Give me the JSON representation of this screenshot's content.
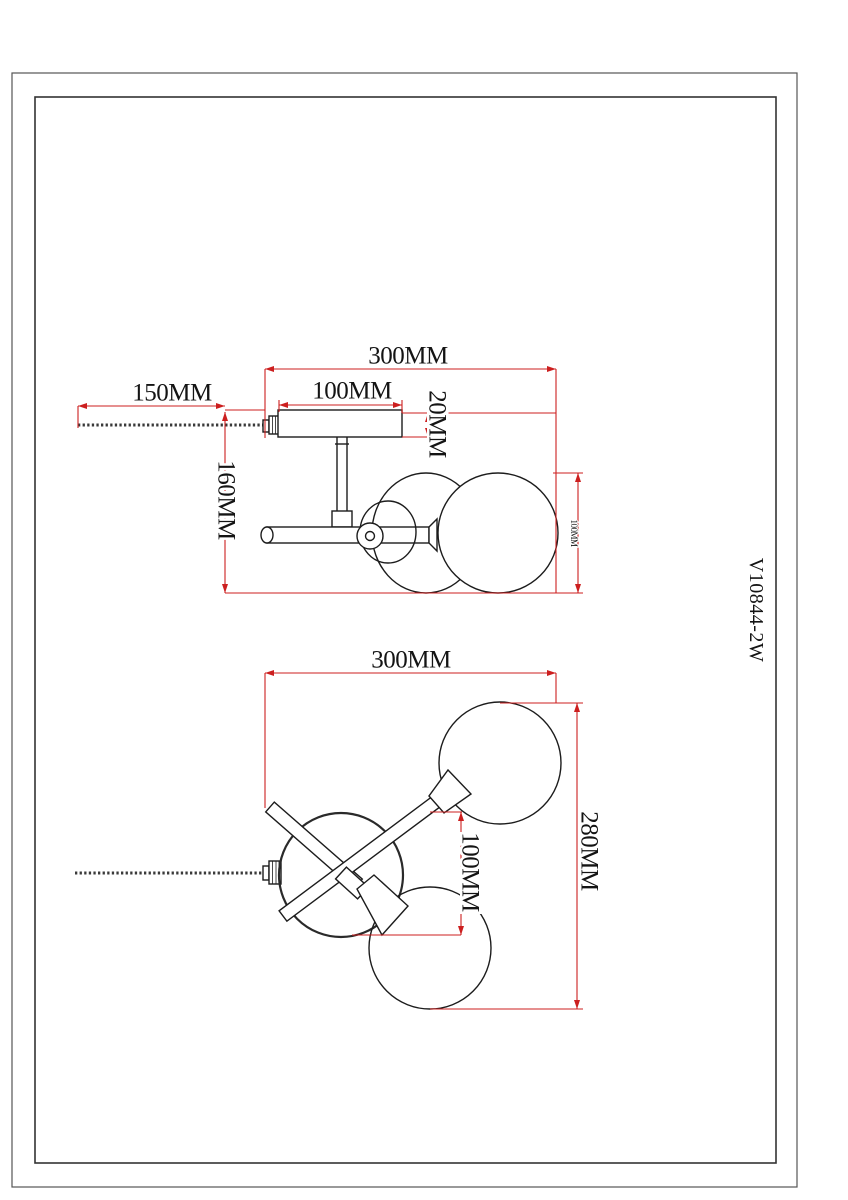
{
  "meta": {
    "part_number": "V10844-2W",
    "sheet_type": "lamp dimension drawing"
  },
  "colors": {
    "dimension_red": "#cc1f1f",
    "line_black": "#1c1c1c",
    "background": "#ffffff"
  },
  "side_view": {
    "dimensions": {
      "overall_width": "300MM",
      "rod_length": "150MM",
      "plate_width": "100MM",
      "plate_thickness": "20MM",
      "fixture_height": "160MM",
      "globe_height": "100MM"
    }
  },
  "plan_view": {
    "dimensions": {
      "overall_width": "300MM",
      "overall_depth": "280MM",
      "globe_offset": "100MM"
    }
  }
}
